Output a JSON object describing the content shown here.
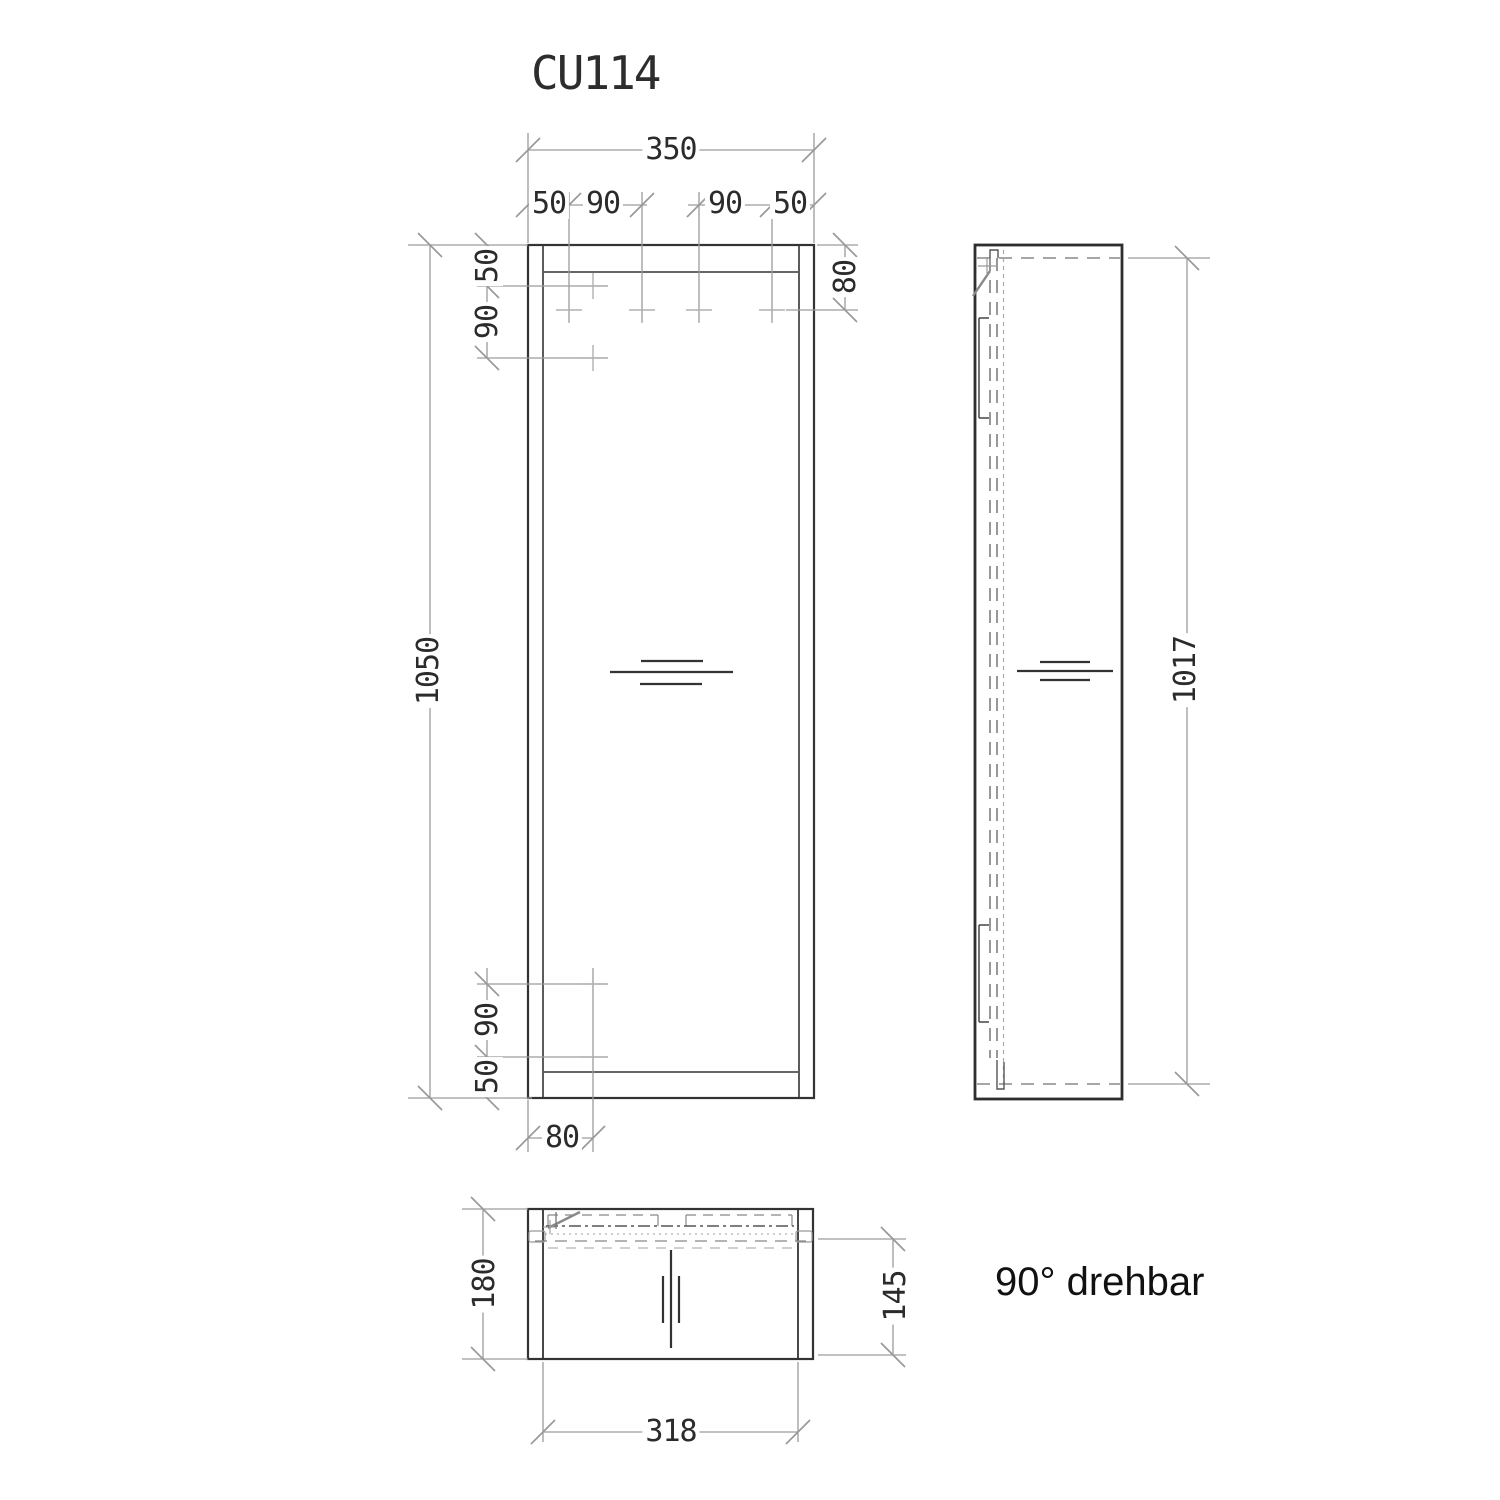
{
  "title": "CU114",
  "note_rotation": "90° drehbar",
  "front_view": {
    "total_width": "350",
    "chain_top": [
      "50",
      "90",
      "90",
      "50"
    ],
    "total_height": "1050",
    "chain_left_top": [
      "50",
      "90"
    ],
    "chain_left_bottom": [
      "90",
      "50"
    ],
    "offset_right": "80",
    "offset_bottom": "80"
  },
  "side_view": {
    "door_height": "1017"
  },
  "plan_view": {
    "total_depth": "180",
    "glass_depth": "145",
    "inner_width": "318"
  },
  "colors": {
    "outline": "#333333",
    "dimension": "#9c9c9c",
    "hidden_dash": "#888888",
    "background": "#ffffff"
  }
}
